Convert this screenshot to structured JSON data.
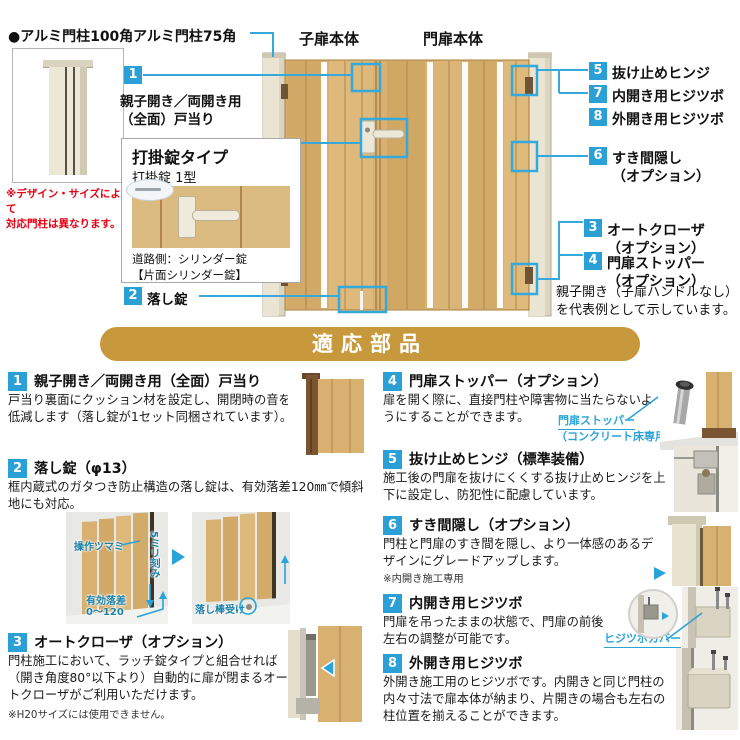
{
  "colors": {
    "accent_blue": "#2AA0D6",
    "line_blue": "#35A8DC",
    "banner_gold": "#C7993C",
    "note_red": "#E60012",
    "wood": "#D8B170",
    "post_beige": "#EAE4D3"
  },
  "top": {
    "post100": {
      "title": "●アルミ門柱100角",
      "note_line1": "※デザイン・サイズによって",
      "note_line2": "対応門柱は異なります。"
    },
    "post75_label": "アルミ門柱75角",
    "child_door_label": "子扉本体",
    "main_door_label": "門扉本体",
    "callout1": {
      "num": "1",
      "line1": "親子開き／両開き用",
      "line2": "（全面）戸当り"
    },
    "callout2": {
      "num": "2",
      "label": "落し錠"
    },
    "lockbox": {
      "title": "打掛錠タイプ",
      "subtitle": "打掛錠 1型",
      "caption1": "道路側：シリンダー錠",
      "caption2": "【片面シリンダー錠】"
    },
    "right_callouts": {
      "c5": {
        "num": "5",
        "label": "抜け止めヒンジ"
      },
      "c7": {
        "num": "7",
        "label": "内開き用ヒジツボ"
      },
      "c8": {
        "num": "8",
        "label": "外開き用ヒジツボ"
      },
      "c6": {
        "num": "6",
        "label": "すき間隠し",
        "label2": "（オプション）"
      },
      "c3": {
        "num": "3",
        "label": "オートクローザ",
        "label2": "（オプション）"
      },
      "c4": {
        "num": "4",
        "label": "門扉ストッパー",
        "label2": "（オプション）"
      }
    },
    "rep_note_line1": "親子開き（子扉ハンドルなし）",
    "rep_note_line2": "を代表例として示しています。"
  },
  "banner": {
    "title": "適応部品"
  },
  "sections": [
    {
      "num": "1",
      "title": "親子開き／両開き用（全面）戸当り",
      "body": "戸当り裏面にクッション材を設定し、開閉時の音を低減します（落し錠が1セット同梱されています）。"
    },
    {
      "num": "2",
      "title": "落し錠（φ13）",
      "body": "框内蔵式のガタつき防止構造の落し錠は、有効落差120㎜で傾斜地にも対応。",
      "annotations": {
        "knob": "操作ツマミ",
        "pitch": "5ミリ刻み",
        "drop1": "有効落差",
        "drop2": "0〜120",
        "receiver": "落し棒受け"
      }
    },
    {
      "num": "3",
      "title": "オートクローザ（オプション）",
      "body": "門柱施工において、ラッチ錠タイプと組合せれば（開き角度80°以下より）自動的に扉が閉まるオートクローザがご利用いただけます。",
      "note": "※H20サイズには使用できません。"
    },
    {
      "num": "4",
      "title": "門扉ストッパー（オプション）",
      "body": "扉を開く際に、直接門柱や障害物に当たらないようにすることができます。",
      "callout_line1": "門扉ストッパー",
      "callout_line2": "（コンクリート床専用）"
    },
    {
      "num": "5",
      "title": "抜け止めヒンジ（標準装備）",
      "body": "施工後の門扉を抜けにくくする抜け止めヒンジを上下に設定し、防犯性に配慮しています。"
    },
    {
      "num": "6",
      "title": "すき間隠し（オプション）",
      "body": "門柱と門扉のすき間を隠し、より一体感のあるデザインにグレードアップします。",
      "note": "※内開き施工専用"
    },
    {
      "num": "7",
      "title": "内開き用ヒジツボ",
      "body": "門扉を吊ったままの状態で、門扉の前後左右の調整が可能です。",
      "callout": "ヒジツボカバー"
    },
    {
      "num": "8",
      "title": "外開き用ヒジツボ",
      "body": "外開き施工用のヒジツボです。内開きと同じ門柱の内々寸法で扉本体が納まり、片開きの場合も左右の柱位置を揃えることができます。"
    }
  ]
}
